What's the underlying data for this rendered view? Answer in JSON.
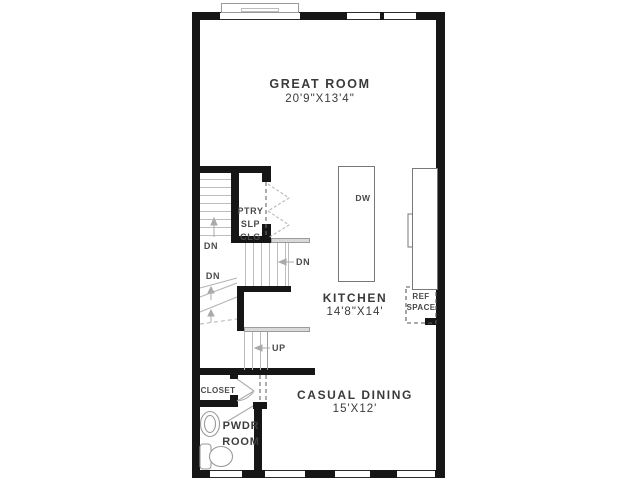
{
  "rooms": {
    "great_room": {
      "name": "GREAT ROOM",
      "dims": "20'9\"X13'4\""
    },
    "kitchen": {
      "name": "KITCHEN",
      "dims": "14'8\"X14'"
    },
    "casual_dining": {
      "name": "CASUAL DINING",
      "dims": "15'X12'"
    },
    "pwdr_room": {
      "line1": "PWDR",
      "line2": "ROOM"
    },
    "closet": {
      "name": "CLOSET"
    },
    "pantry": {
      "line1": "PTRY",
      "line2": "SLP",
      "line3": "CLG"
    }
  },
  "fixtures": {
    "dishwasher": "DW",
    "ref_line1": "REF",
    "ref_line2": "SPACE"
  },
  "stairs": {
    "down": "DN",
    "up": "UP"
  },
  "colors": {
    "wall": "#161616",
    "text": "#3d3d3d",
    "fixture_gray": "#8f8f8f",
    "tread_gray": "#bdbdbd"
  }
}
